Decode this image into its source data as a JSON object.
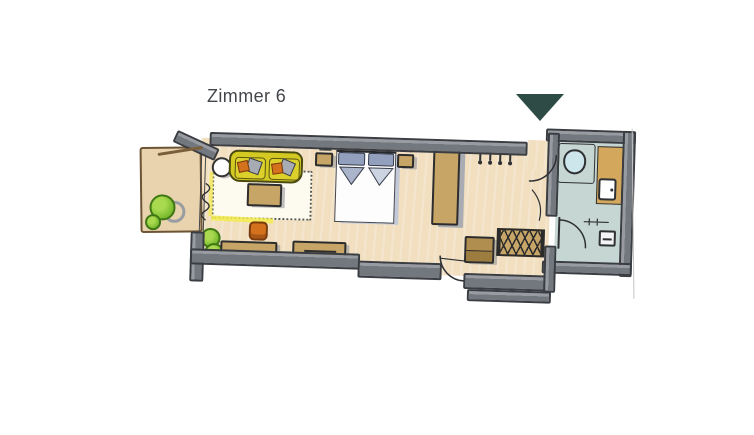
{
  "header": {
    "title": "Zimmer 6"
  },
  "entrance_marker": {
    "shape": "triangle-down"
  },
  "colors": {
    "paper": "#ffffff",
    "ink": "#2e3033",
    "text": "#43464a",
    "wall": "#73777e",
    "wall-edge": "#3a3d42",
    "floor": "#f1dfc0",
    "floor-balcony": "#e9d3ae",
    "floor-bath": "#c6d6d2",
    "rug": "#fdfaef",
    "sofa": "#d4c922",
    "sofa-edge": "#4a4a10",
    "wood": "#c7a567",
    "wood-dark": "#b08e4f",
    "vanity": "#d3a85c",
    "orange": "#d4711c",
    "pillow-gray": "#a7abb3",
    "bed-pillow": "#93a0bd",
    "bed-fold-1": "#aab4ca",
    "bed-fold-2": "#ccd4e2",
    "duvet": "#fdfdfe",
    "plant": "#85c336",
    "plant-edge": "#3f7714",
    "marker": "#2e4c45",
    "shower": "#cde6ec",
    "highlight": "#f3ec4e"
  },
  "furniture_icons": [
    "sofa",
    "side-table",
    "coffee-table",
    "rug",
    "pouf",
    "plant",
    "sideboard",
    "double-bed",
    "nightstand",
    "wardrobe",
    "coat-hooks",
    "bench",
    "luggage-rack",
    "shower",
    "washbasin",
    "toilet",
    "balcony-chair",
    "balcony-door",
    "entrance-door",
    "bathroom-door",
    "connecting-door",
    "curtain"
  ]
}
